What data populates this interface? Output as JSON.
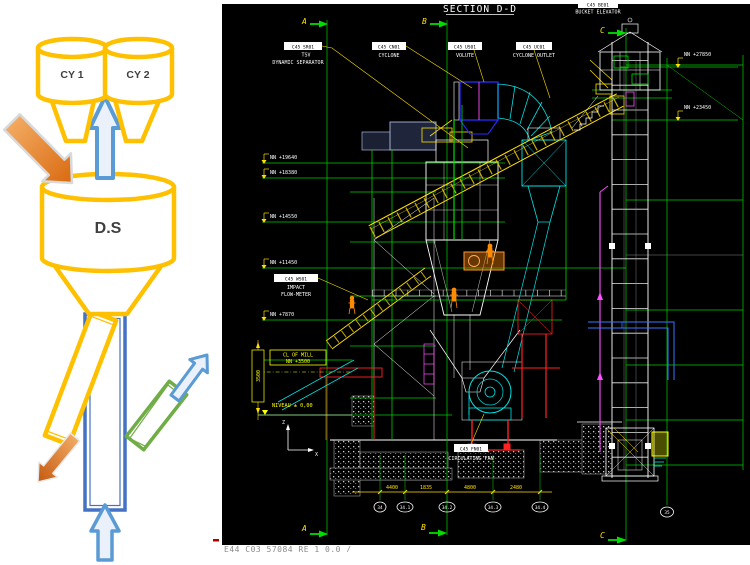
{
  "left_diagram": {
    "cyclone1_label": "CY 1",
    "cyclone2_label": "CY 2",
    "separator_label": "D.S",
    "colors": {
      "vessel_outline": "#FFC000",
      "flow_arrow_blue": "#5B9BD5",
      "feed_arrow_orange": "#ED7D31",
      "reject_duct_green": "#70AD47"
    }
  },
  "cad": {
    "title": "SECTION D-D",
    "footer_doc": "E44 C03 57084 RE 1  0.0 /",
    "grid": {
      "top_markers": [
        "A",
        "B",
        "C"
      ],
      "bottom_markers": [
        "A",
        "B",
        "C"
      ],
      "bubbles": [
        "34",
        "34.1",
        "34.2",
        "34.3",
        "34.4",
        "35"
      ]
    },
    "tags": {
      "separator": {
        "code": "C45 SR01",
        "line1": "TSV",
        "line2": "DYNAMIC SEPARATOR"
      },
      "cyclone": {
        "code": "C45 CN01",
        "line1": "CYCLONE"
      },
      "volute": {
        "code": "C45 US01",
        "line1": "VOLUTE"
      },
      "cyclone_outlet": {
        "code": "C45 UC01",
        "line1": "CYCLONE OUTLET"
      },
      "bucket_elevator": {
        "code": "C45 BE01",
        "line1": "BUCKET ELEVATOR"
      },
      "flow_meter": {
        "code": "C45 WS01",
        "line1": "IMPACT",
        "line2": "FLOW-METER"
      },
      "circulating_fan": {
        "code": "C45 FN01",
        "line1": "CIRCULATING FAN"
      }
    },
    "elevations_left": [
      "NN +19640",
      "NN +18380",
      "NN +14550",
      "NN +11450",
      "NN +7870"
    ],
    "elevations_right": [
      "NN +27850",
      "NN +23450"
    ],
    "mill_centerline": {
      "line1": "CL OF MILL",
      "line2": "NN +3500"
    },
    "level_label": "NIVEAU ± 0,00",
    "vertical_dim": "3500",
    "dimensions": [
      "4400",
      "1835",
      "4800",
      "2480"
    ],
    "axes": {
      "vertical": "Z",
      "horizontal": "X"
    },
    "colors": {
      "background": "#000000",
      "structure_green": "#00DD00",
      "annotation_yellow": "#FFE000",
      "duct_cyan": "#00E5E5",
      "steel_white": "#FFFFFF",
      "support_red": "#FF2222",
      "pipe_magenta": "#FF50FF"
    }
  }
}
